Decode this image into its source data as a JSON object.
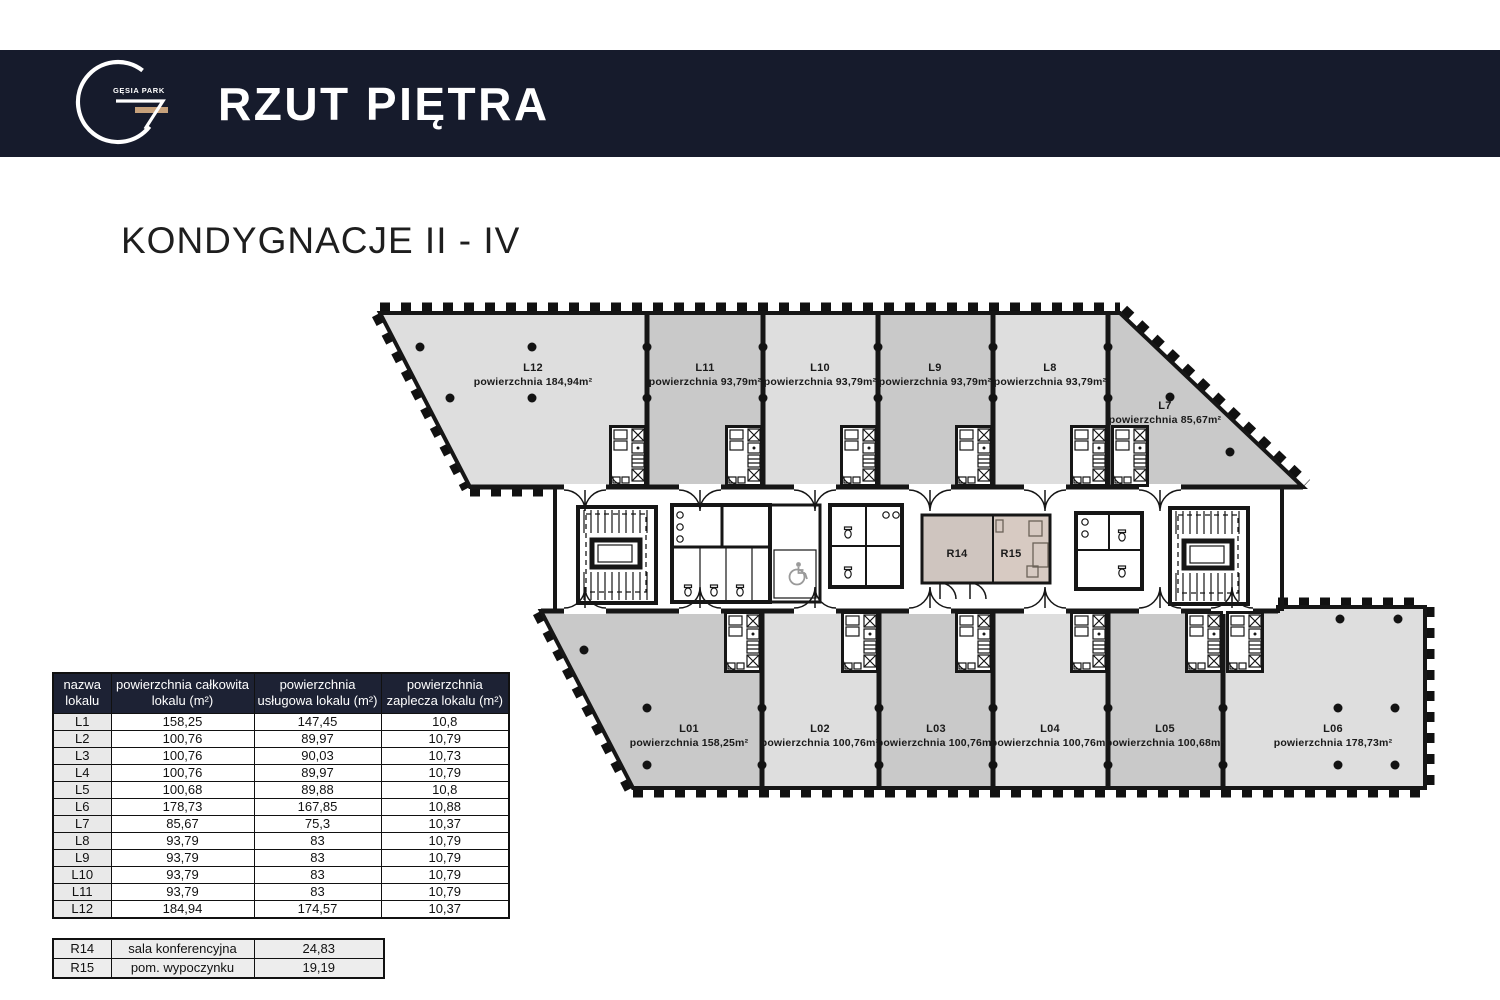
{
  "header": {
    "logo_text": "GĘSIA PARK",
    "title": "RZUT PIĘTRA"
  },
  "subtitle": "KONDYGNACJE II - IV",
  "colors": {
    "navy_bar": "#161b2c",
    "table_header_navy": "#1d2234",
    "logo_gold": "#c6a17b",
    "unit_light_gray": "#dedede",
    "unit_dark_gray": "#c9c9c9",
    "room_r14_beige": "#cfc5bf",
    "room_r15_beige": "#d7cac2",
    "wall_black": "#161616"
  },
  "plan": {
    "top_units": [
      {
        "name": "L12",
        "area": "powierzchnia 184,94m²"
      },
      {
        "name": "L11",
        "area": "powierzchnia 93,79m²"
      },
      {
        "name": "L10",
        "area": "powierzchnia 93,79m²"
      },
      {
        "name": "L9",
        "area": "powierzchnia 93,79m²"
      },
      {
        "name": "L8",
        "area": "powierzchnia 93,79m²"
      },
      {
        "name": "L7",
        "area": "powierzchnia 85,67m²"
      }
    ],
    "bottom_units": [
      {
        "name": "L01",
        "area": "powierzchnia 158,25m²"
      },
      {
        "name": "L02",
        "area": "powierzchnia 100,76m²"
      },
      {
        "name": "L03",
        "area": "powierzchnia 100,76m²"
      },
      {
        "name": "L04",
        "area": "powierzchnia 100,76m²"
      },
      {
        "name": "L05",
        "area": "powierzchnia 100,68m²"
      },
      {
        "name": "L06",
        "area": "powierzchnia 178,73m²"
      }
    ],
    "rooms": [
      {
        "name": "R14"
      },
      {
        "name": "R15"
      }
    ]
  },
  "main_table": {
    "headers": [
      "nazwa lokalu",
      "powierzchnia całkowita lokalu (m²)",
      "powierzchnia usługowa lokalu (m²)",
      "powierzchnia zaplecza lokalu (m²)"
    ],
    "rows": [
      [
        "L1",
        "158,25",
        "147,45",
        "10,8"
      ],
      [
        "L2",
        "100,76",
        "89,97",
        "10,79"
      ],
      [
        "L3",
        "100,76",
        "90,03",
        "10,73"
      ],
      [
        "L4",
        "100,76",
        "89,97",
        "10,79"
      ],
      [
        "L5",
        "100,68",
        "89,88",
        "10,8"
      ],
      [
        "L6",
        "178,73",
        "167,85",
        "10,88"
      ],
      [
        "L7",
        "85,67",
        "75,3",
        "10,37"
      ],
      [
        "L8",
        "93,79",
        "83",
        "10,79"
      ],
      [
        "L9",
        "93,79",
        "83",
        "10,79"
      ],
      [
        "L10",
        "93,79",
        "83",
        "10,79"
      ],
      [
        "L11",
        "93,79",
        "83",
        "10,79"
      ],
      [
        "L12",
        "184,94",
        "174,57",
        "10,37"
      ]
    ]
  },
  "room_table": {
    "rows": [
      [
        "R14",
        "sala konferencyjna",
        "24,83"
      ],
      [
        "R15",
        "pom. wypoczynku",
        "19,19"
      ]
    ]
  }
}
